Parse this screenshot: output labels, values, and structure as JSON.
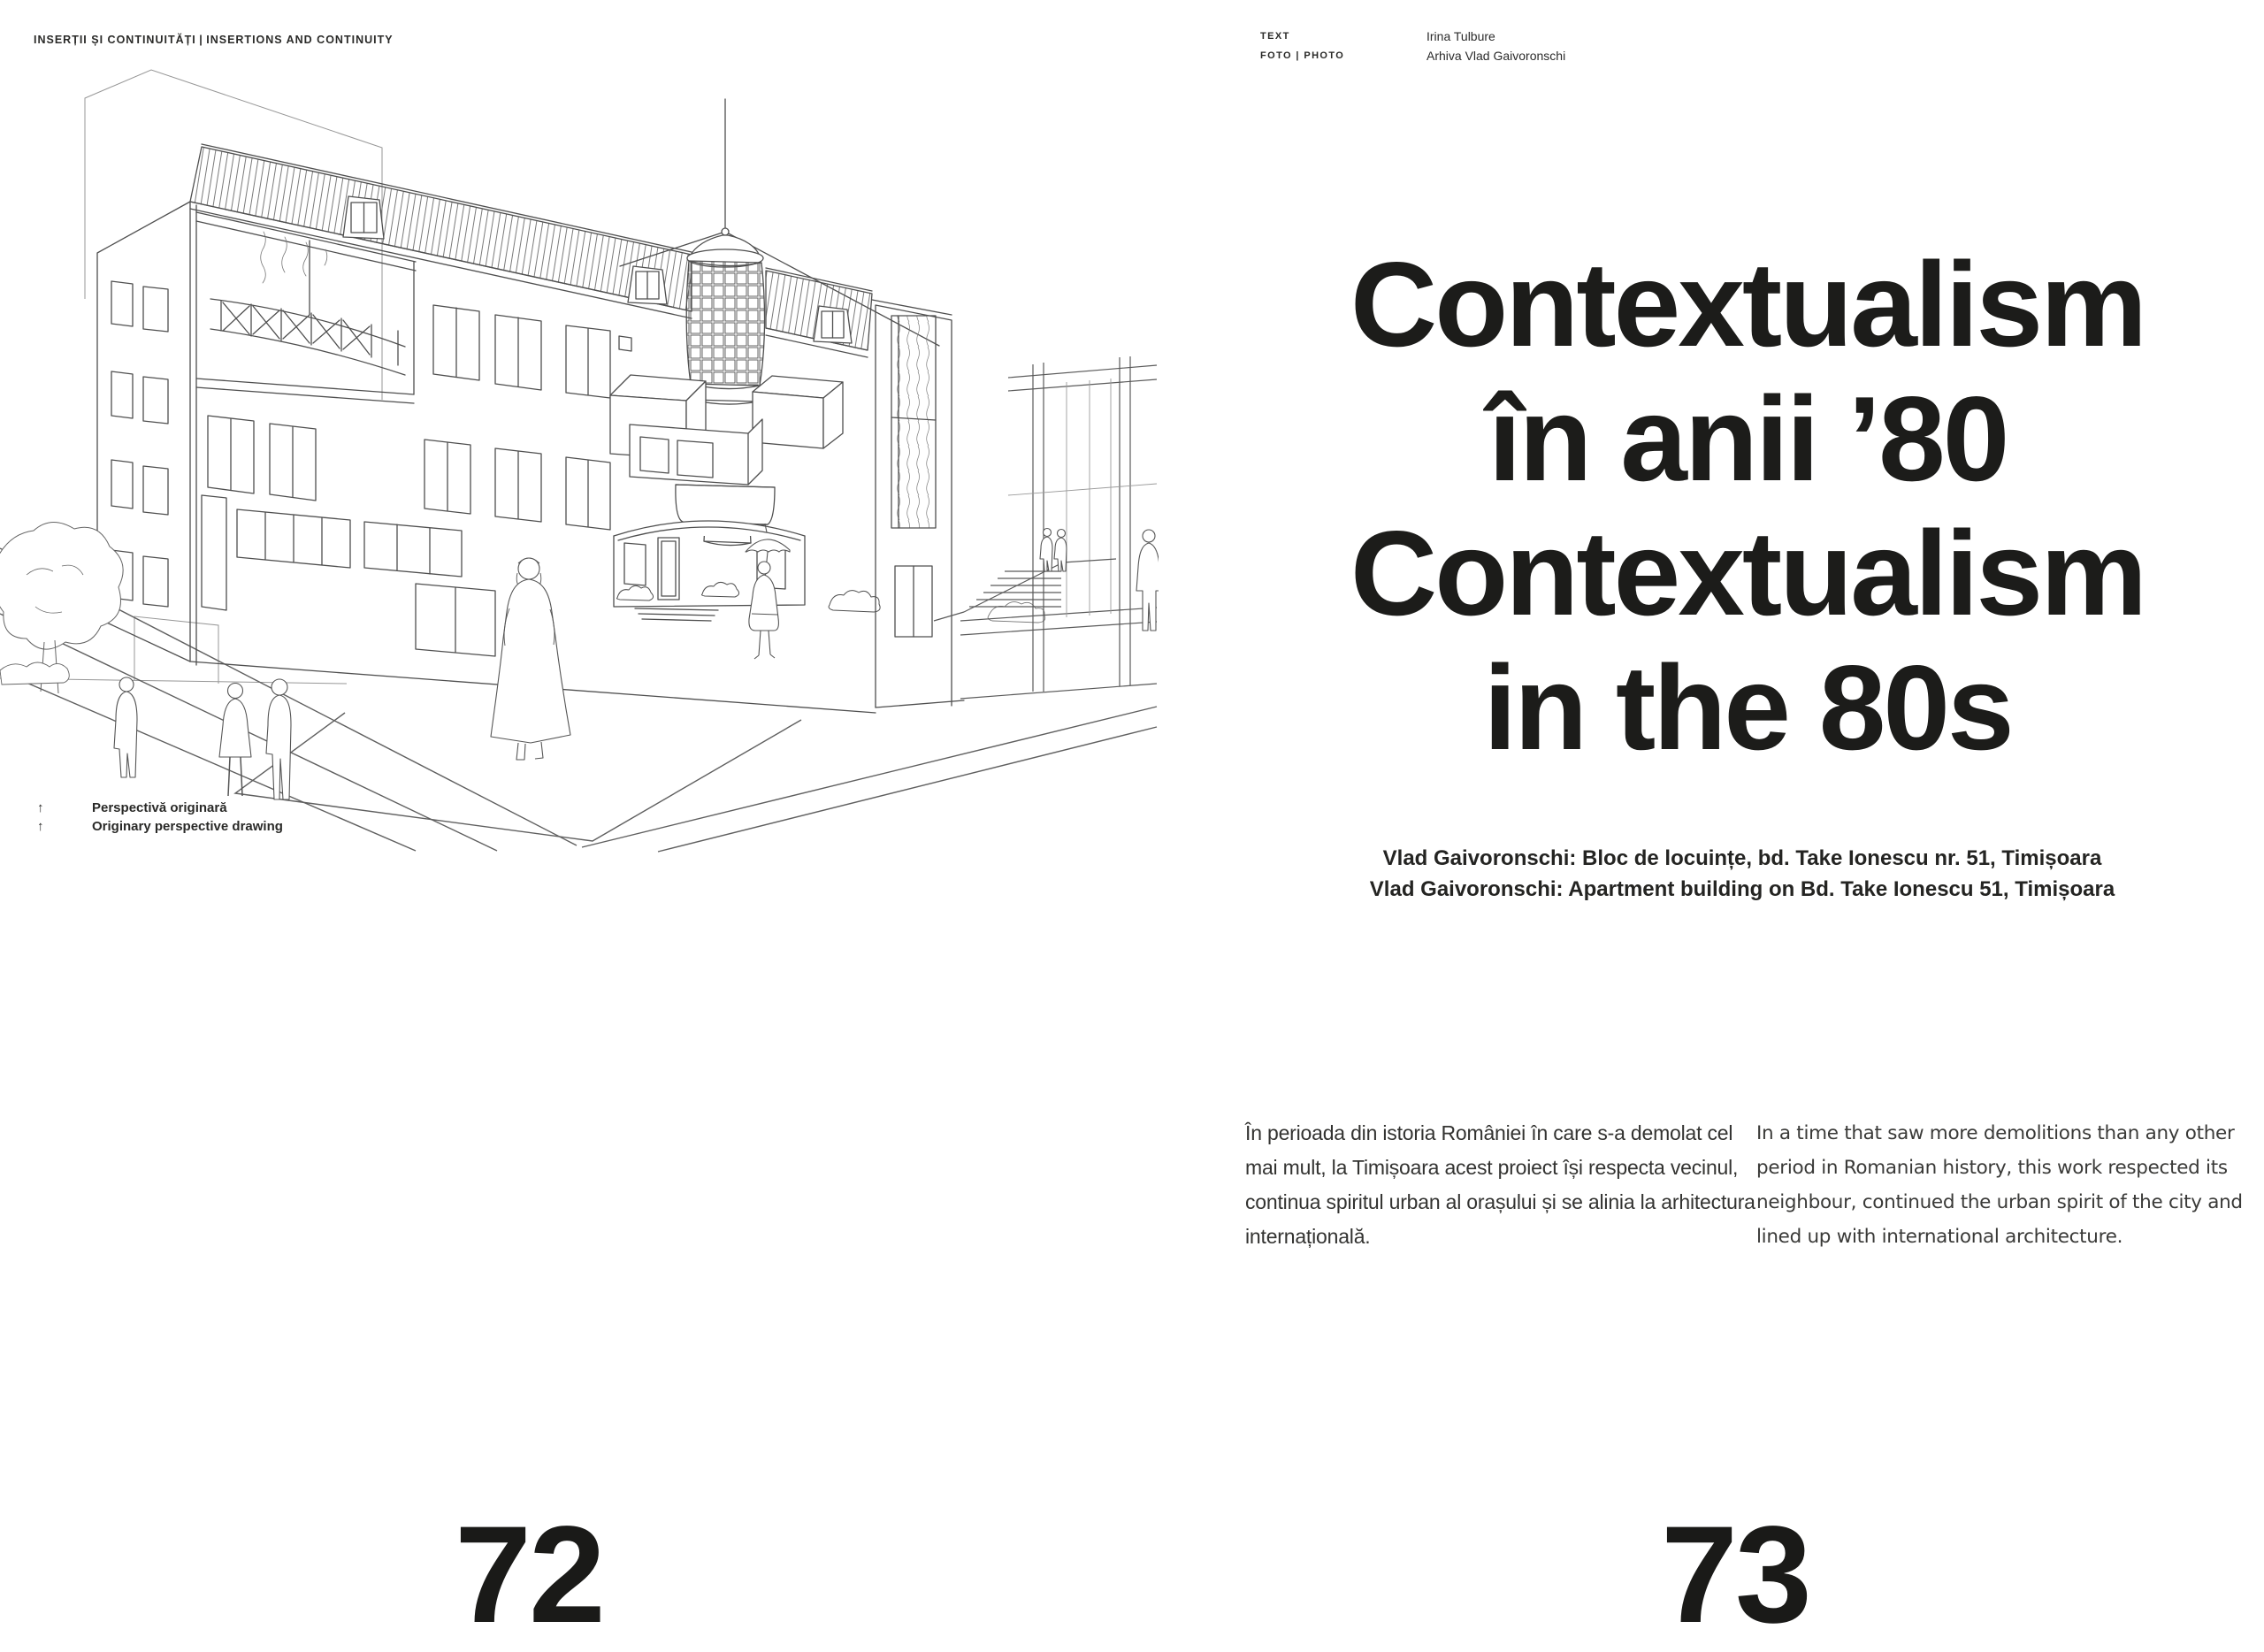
{
  "page_left": {
    "running_head": "INSERȚII ȘI CONTINUITĂȚI | INSERTIONS AND CONTINUITY",
    "figure": {
      "name": "perspective-drawing",
      "caption": [
        {
          "icon": "arrow-up",
          "text": "Perspectivă originară"
        },
        {
          "icon": "arrow-up",
          "text": "Originary perspective drawing"
        }
      ]
    },
    "page_number": "72"
  },
  "page_right": {
    "credits": [
      {
        "label": "TEXT",
        "value": "Irina Tulbure"
      },
      {
        "label": "FOTO | PHOTO",
        "value": "Arhiva Vlad Gaivoronschi"
      }
    ],
    "title_lines": [
      "Contextualism",
      "în anii ’80",
      "Contextualism",
      "in the 80s"
    ],
    "subtitle_lines": [
      "Vlad Gaivoronschi: Bloc de locuințe, bd. Take Ionescu nr. 51, Timișoara",
      "Vlad Gaivoronschi: Apartment building on Bd. Take Ionescu 51, Timișoara"
    ],
    "body_ro": "În perioada din istoria României în care s-a demolat cel mai mult, la Timișoara acest proiect își respecta vecinul, continua spiritul urban al orașului și se alinia la arhitectura internațională.",
    "body_en": "In a time that saw more demolitions than any other period in Romanian history, this work respected its neighbour, continued the urban spirit of the city and lined up with international architecture.",
    "page_number": "73"
  },
  "icons": {
    "arrow_up": "↑"
  },
  "colors": {
    "ink": "#1c1c1a",
    "body_text": "#333331",
    "drawing_line": "#4f4f4f",
    "paper": "#ffffff"
  }
}
